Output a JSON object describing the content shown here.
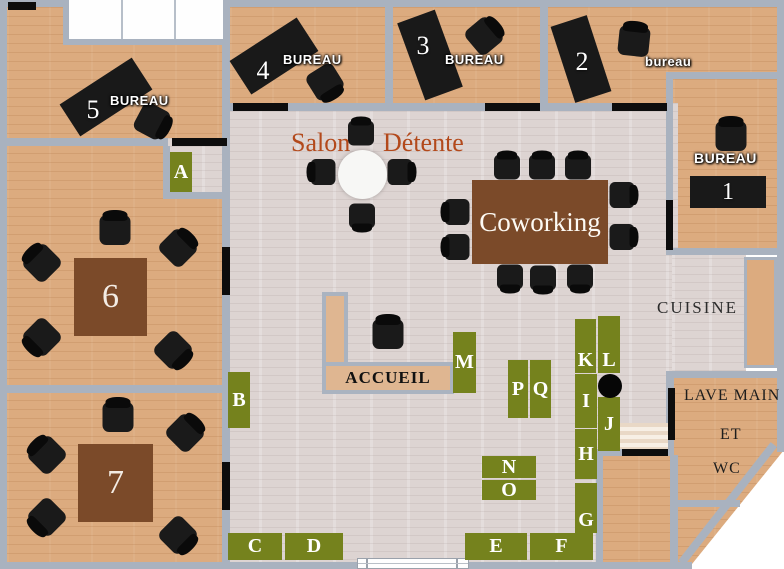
{
  "rooms": {
    "bureau5": {
      "label": "BUREAU",
      "number": "5"
    },
    "bureau4": {
      "label": "BUREAU",
      "number": "4"
    },
    "bureau3": {
      "label": "BUREAU",
      "number": "3"
    },
    "bureau2": {
      "label": "bureau",
      "number": "2"
    },
    "bureau1": {
      "label": "BUREAU",
      "number": "1"
    },
    "salle6": {
      "number": "6"
    },
    "salle7": {
      "number": "7"
    },
    "salon": {
      "word1": "Salon",
      "word2": "Détente"
    },
    "coworking": {
      "label": "Coworking"
    },
    "cuisine": {
      "label": "CUISINE"
    },
    "accueil": {
      "label": "ACCUEIL"
    },
    "sanitaires": {
      "line1": "LAVE MAIN",
      "line2": "ET",
      "line3": "WC"
    }
  },
  "markers": [
    {
      "letter": "A"
    },
    {
      "letter": "B"
    },
    {
      "letter": "C"
    },
    {
      "letter": "D"
    },
    {
      "letter": "E"
    },
    {
      "letter": "F"
    },
    {
      "letter": "G"
    },
    {
      "letter": "H"
    },
    {
      "letter": "I"
    },
    {
      "letter": "J"
    },
    {
      "letter": "K"
    },
    {
      "letter": "L"
    },
    {
      "letter": "M"
    },
    {
      "letter": "N"
    },
    {
      "letter": "O"
    },
    {
      "letter": "P"
    },
    {
      "letter": "Q"
    }
  ],
  "colors": {
    "marker_green": "#75821d",
    "wall_gray": "#a9b2bf",
    "wood_tan": "#dcab7f",
    "floor_light": "#ddd4d2",
    "table_brown": "#7b4a29",
    "salon_text": "#b3491b"
  }
}
